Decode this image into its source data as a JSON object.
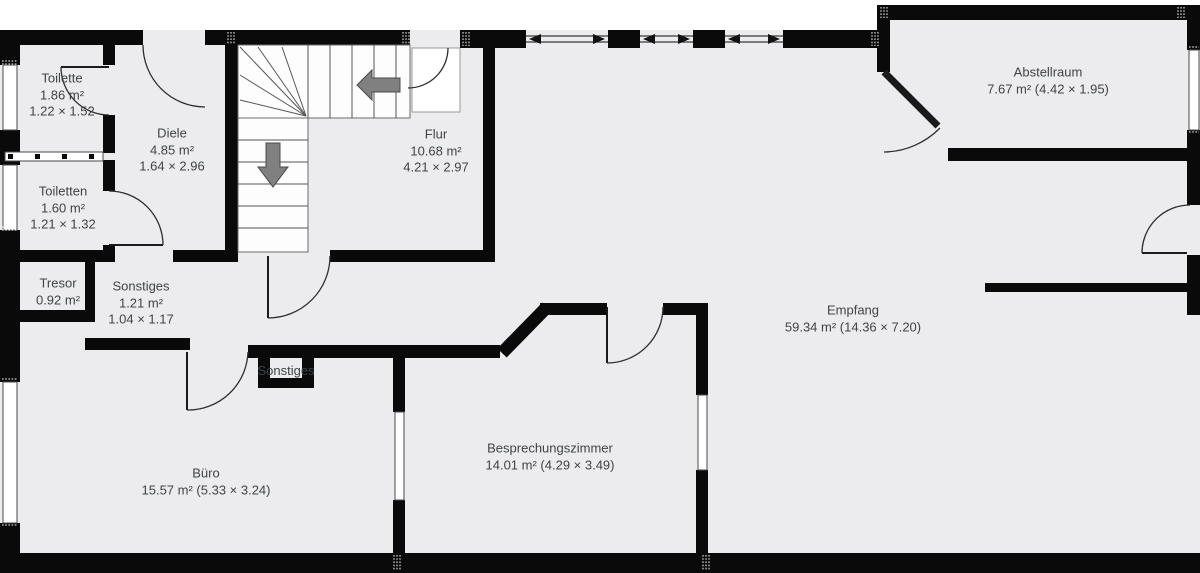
{
  "colors": {
    "floor": "#ececee",
    "wall": "#0a0a0b",
    "outside": "#ffffff",
    "stair_arrow": "#808080",
    "label_text": "#3f4347"
  },
  "rooms": {
    "toilette": {
      "name": "Toilette",
      "area": "1.86 m²",
      "dims": "1.22 × 1.52"
    },
    "toiletten": {
      "name": "Toiletten",
      "area": "1.60 m²",
      "dims": "1.21 × 1.32"
    },
    "diele": {
      "name": "Diele",
      "area": "4.85 m²",
      "dims": "1.64 × 2.96"
    },
    "flur": {
      "name": "Flur",
      "area": "10.68 m²",
      "dims": "4.21 × 2.97"
    },
    "abstellraum": {
      "name": "Abstellraum",
      "area_dims": "7.67 m² (4.42 × 1.95)"
    },
    "tresor": {
      "name": "Tresor",
      "area": "0.92 m²"
    },
    "sonstiges": {
      "name": "Sonstiges",
      "area": "1.21 m²",
      "dims": "1.04 × 1.17"
    },
    "sonstiges_small": {
      "name": "Sonstiges"
    },
    "empfang": {
      "name": "Empfang",
      "area_dims": "59.34 m² (14.36 × 7.20)"
    },
    "buero": {
      "name": "Büro",
      "area_dims": "15.57 m² (5.33 × 3.24)"
    },
    "besprechungszimmer": {
      "name": "Besprechungszimmer",
      "area_dims": "14.01 m² (4.29 × 3.49)"
    }
  }
}
